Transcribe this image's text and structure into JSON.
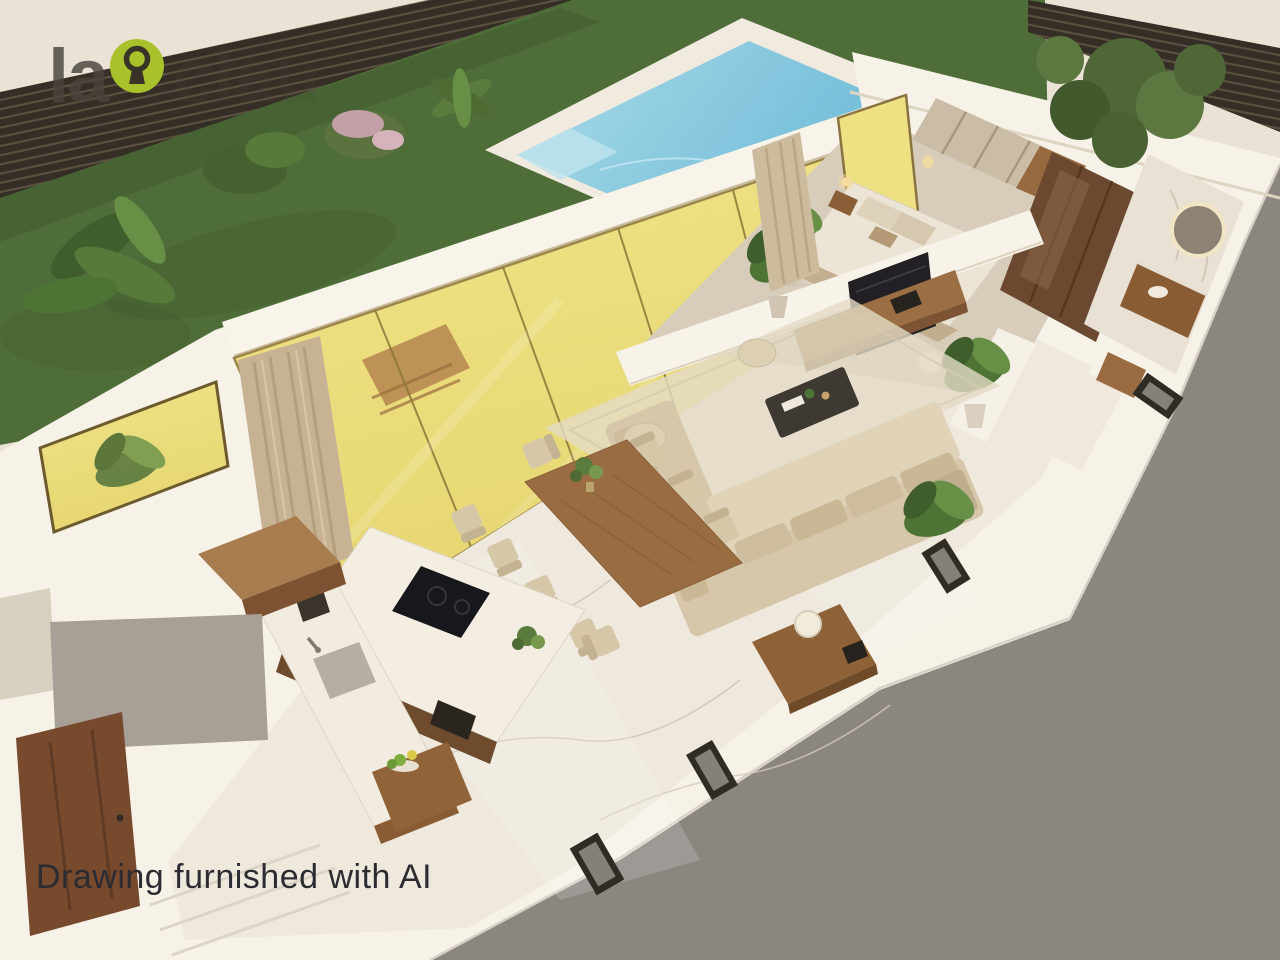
{
  "watermark": {
    "prefix": "la",
    "suffix": "clau",
    "icon": "keyhole-icon",
    "accent_green": "#a9c22c",
    "ink": "#4a453d",
    "keyhole_dark": "#3a3428"
  },
  "caption": {
    "text": "Drawing furnished with AI",
    "color": "#2c2b32"
  },
  "palette": {
    "backdrop_gray": "#8b8680",
    "canvas_beige": "#eae3d5",
    "lawn_green": "#4f6d38",
    "fence_dark": "#342e26",
    "fence_light": "#5b5140",
    "pool_deep": "#63b4d4",
    "pool_light": "#a9dbe8",
    "pool_deck": "#f0eadf",
    "glass_yellow_top": "#f0e489",
    "glass_yellow_bottom": "#e6d671",
    "wall_white": "#f7f2e8",
    "floor_marble": "#efe9dd",
    "wood_mid": "#9a6c42",
    "wood_dark": "#6e4b2c",
    "sofa_beige": "#d6c7aa",
    "rug_beige": "#e4dbc6",
    "foliage_green": "#4e7435"
  }
}
